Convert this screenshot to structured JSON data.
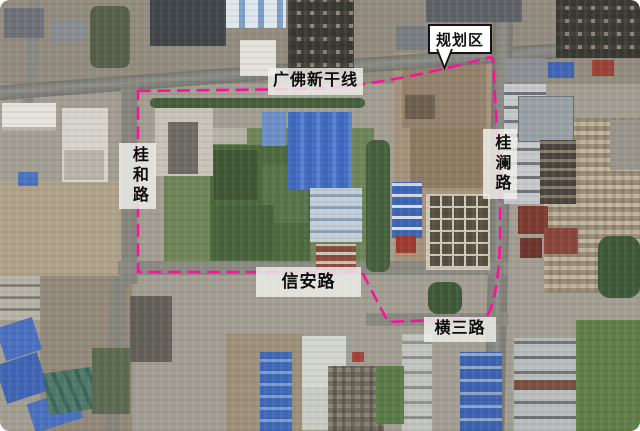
{
  "map": {
    "type": "satellite",
    "callout": {
      "label": "规划区"
    },
    "road_labels": {
      "top": "广佛新干线",
      "left": "桂和路",
      "right": "桂澜路",
      "bottom": "信安路",
      "bottom_right": "横三路"
    },
    "boundary": {
      "color": "#f6149b",
      "style": "dashed"
    }
  }
}
